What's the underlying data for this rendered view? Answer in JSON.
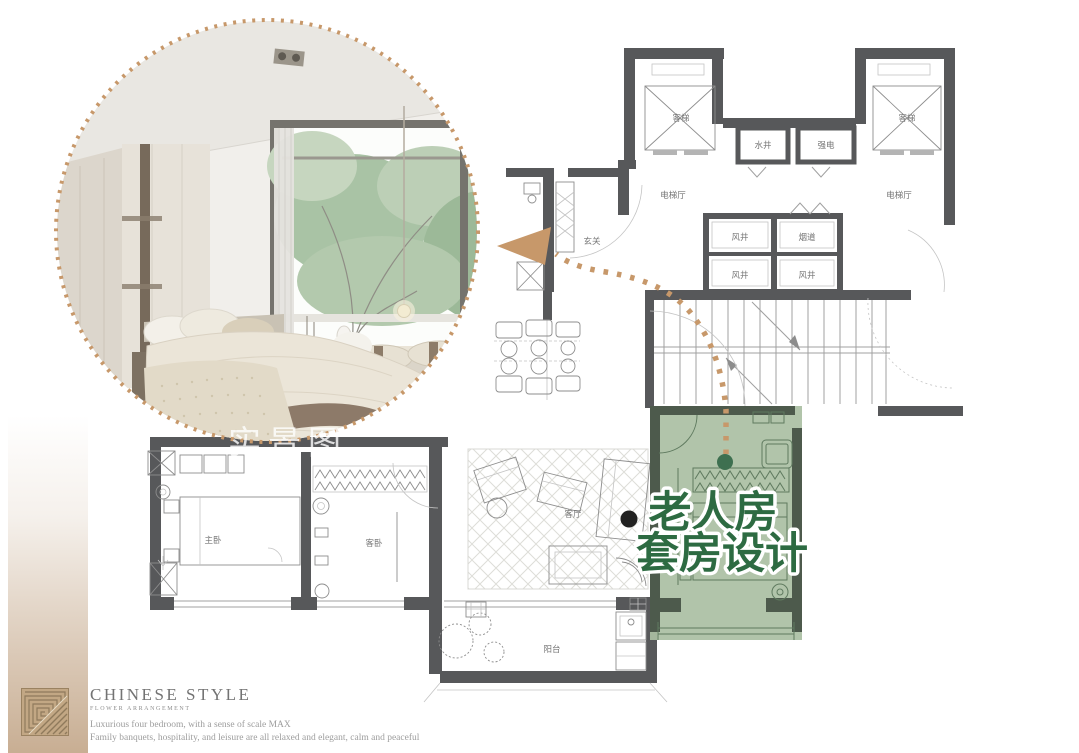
{
  "photo": {
    "watermark": "实景图"
  },
  "headline": {
    "line1": "老人房",
    "line2": "套房设计"
  },
  "floorplan": {
    "labels": {
      "elevator_left": "客梯",
      "elevator_right": "客梯",
      "water_shaft": "水井",
      "strong_electric": "强电",
      "elevator_hall_left": "电梯厅",
      "elevator_hall_right": "电梯厅",
      "wind_shaft_1": "风井",
      "flue": "烟道",
      "wind_shaft_2": "风井",
      "wind_shaft_3": "风井",
      "entry": "玄关",
      "master_bedroom": "主卧",
      "guest_bedroom": "客卧",
      "living_room": "客厅",
      "balcony": "阳台"
    }
  },
  "brand": {
    "title": "CHINESE STYLE",
    "subtitle": "FLOWER ARRANGEMENT",
    "line1": "Luxurious four bedroom, with a sense of scale MAX",
    "line2": "Family banquets, hospitality, and leisure are all relaxed and elegant, calm and peaceful"
  },
  "colors": {
    "arrow_gold": "#c7986a",
    "headline_green": "#2d6b42",
    "highlight_green": "#aabfa3",
    "wall_gray": "#57585a",
    "bar_tan": "#c8ae93"
  }
}
